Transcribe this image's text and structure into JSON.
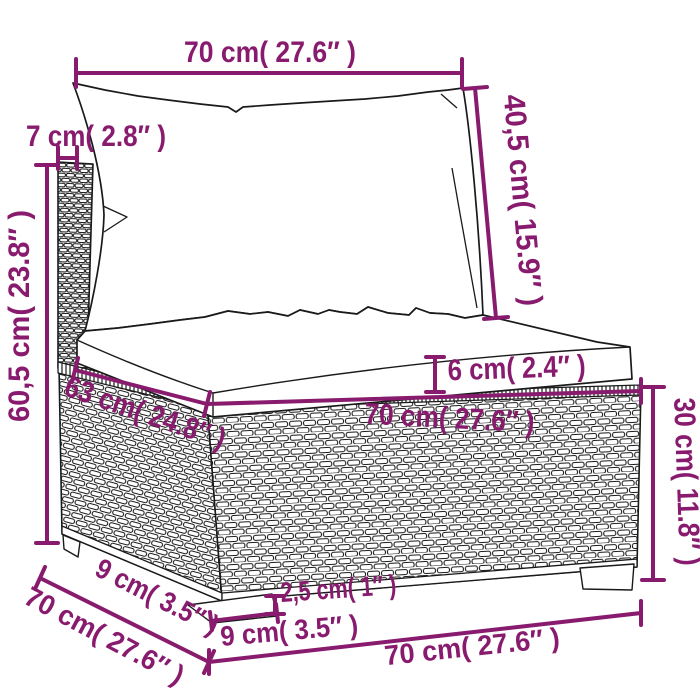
{
  "figure": {
    "type": "furniture-dimension-diagram",
    "subject": "poly rattan garden sofa middle section with back cushion and seat cushion"
  },
  "colors": {
    "accent": "#881b6e",
    "line": "#1a1a1a",
    "background": "#ffffff"
  },
  "dimensions": {
    "top_width": {
      "label": "70 cm( 27.6″  )",
      "cm": 70,
      "in": 27.6
    },
    "back_depth": {
      "label": "7 cm( 2.8″  )",
      "cm": 7,
      "in": 2.8
    },
    "back_cushion_height": {
      "label": "40,5 cm( 15.9″  )",
      "cm": 40.5,
      "in": 15.9
    },
    "total_height": {
      "label": "60,5 cm( 23.8″  )",
      "cm": 60.5,
      "in": 23.8
    },
    "seat_cushion_thickness": {
      "label": "6 cm( 2.4″  )",
      "cm": 6,
      "in": 2.4
    },
    "seat_depth": {
      "label": "63 cm( 24.8″  )",
      "cm": 63,
      "in": 24.8
    },
    "seat_width": {
      "label": "70 cm( 27.6″  )",
      "cm": 70,
      "in": 27.6
    },
    "base_height": {
      "label": "30 cm( 11.8″  )",
      "cm": 30,
      "in": 11.8
    },
    "foot_height": {
      "label": "2,5 cm( 1″  )",
      "cm": 2.5,
      "in": 1
    },
    "foot_inset_depth": {
      "label": "9 cm( 3.5″  )",
      "cm": 9,
      "in": 3.5
    },
    "foot_inset_width": {
      "label": "9 cm( 3.5″  )",
      "cm": 9,
      "in": 3.5
    },
    "total_depth": {
      "label": "70 cm( 27.6″  )",
      "cm": 70,
      "in": 27.6
    },
    "base_front_width": {
      "label": "70 cm( 27.6″  )",
      "cm": 70,
      "in": 27.6
    }
  }
}
